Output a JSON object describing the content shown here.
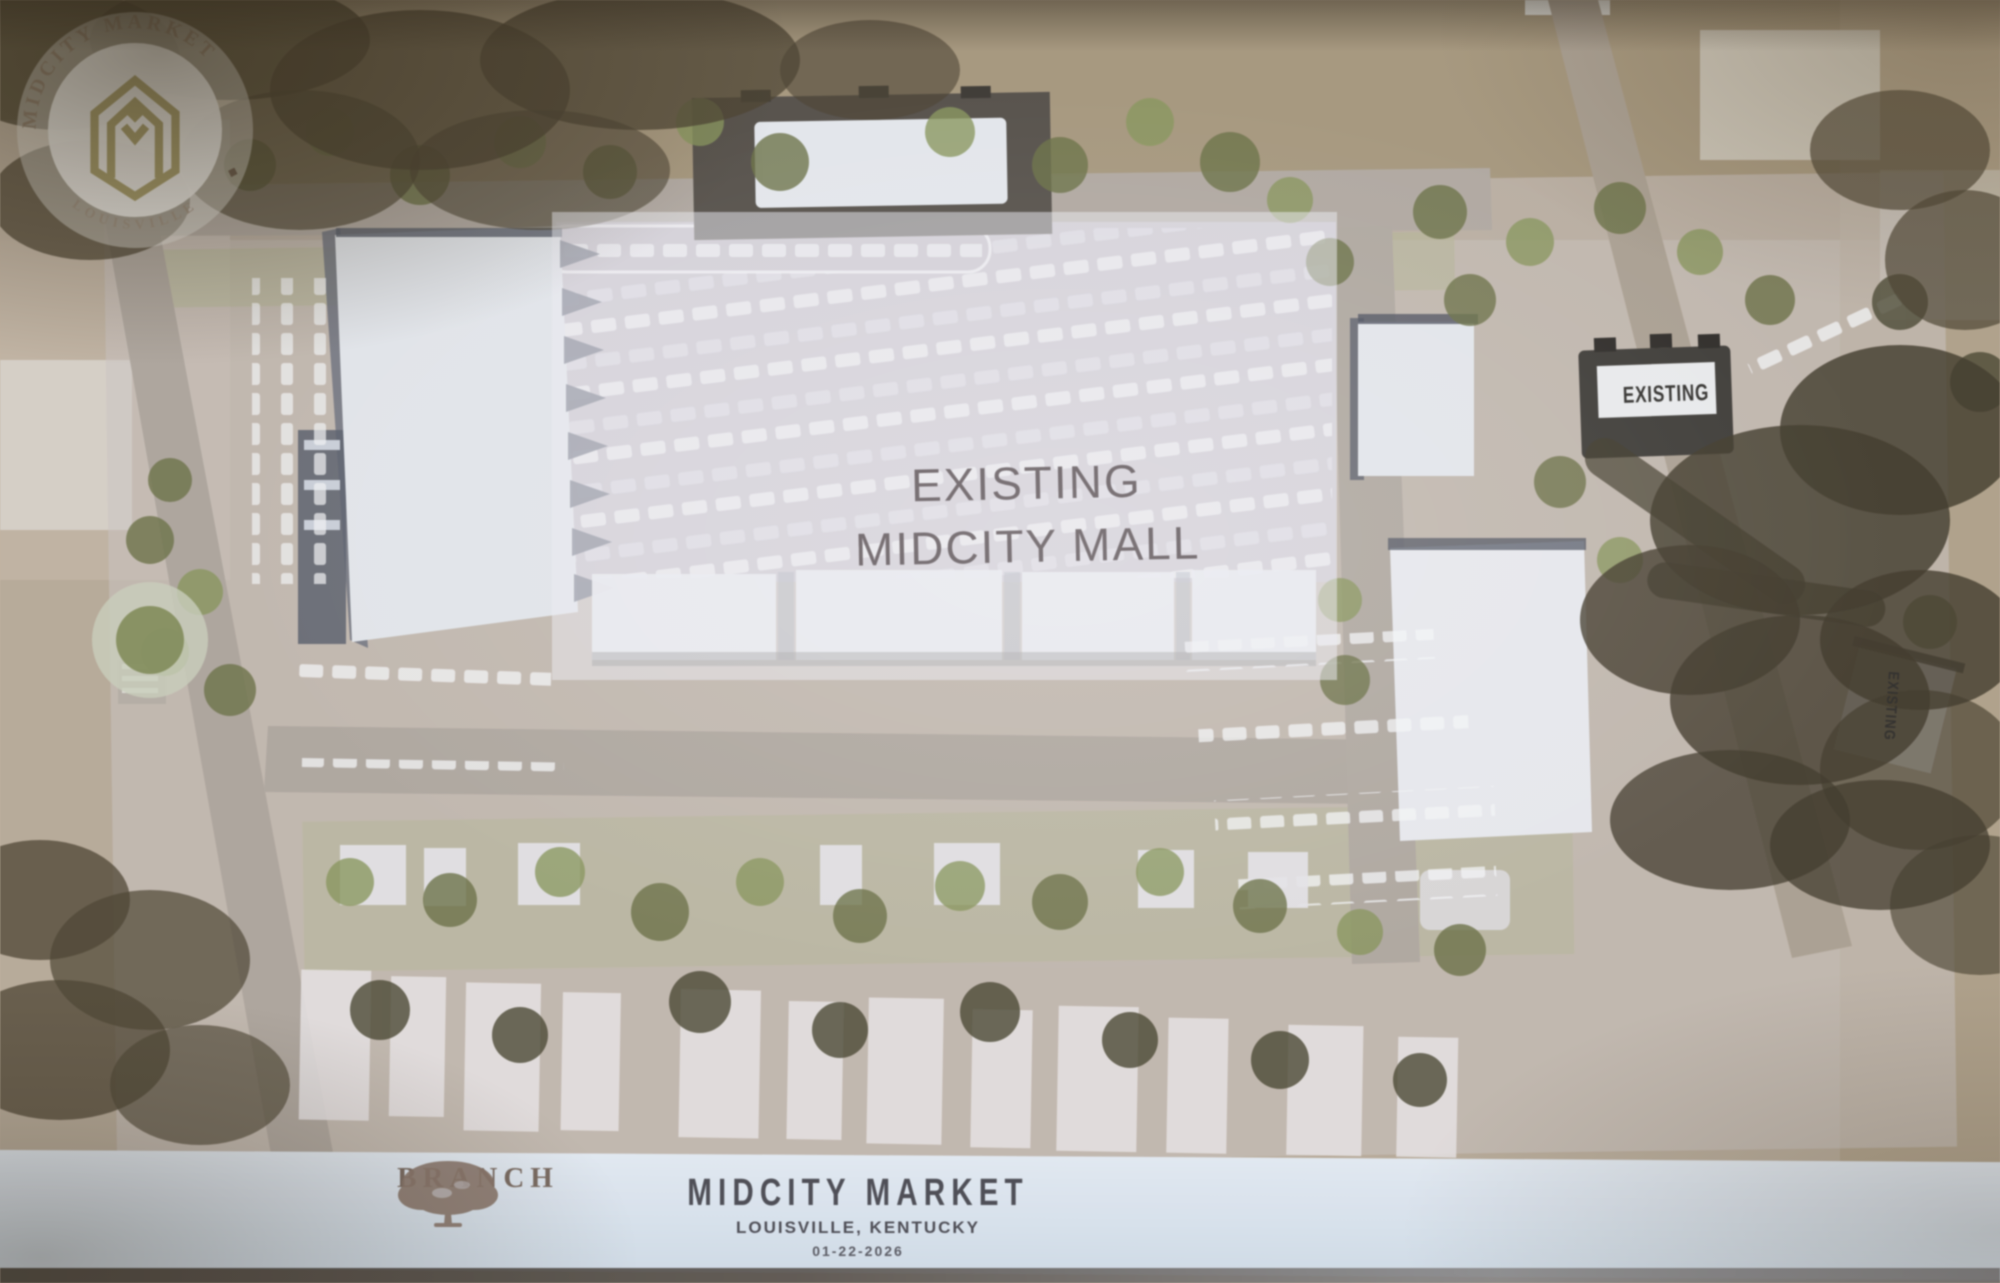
{
  "site_plan": {
    "mall_overlay_label": {
      "line1": "EXISTING",
      "line2": "MIDCITY MALL"
    },
    "building_labels": [
      {
        "id": "northeast-existing-building",
        "text": "EXISTING"
      },
      {
        "id": "east-existing-building",
        "text": "EXISTING"
      }
    ]
  },
  "footer": {
    "badge": {
      "arc_top": "MIDCITY MARKET",
      "separator": "◆",
      "arc_bottom": "LOUISVILLE"
    },
    "branch_logo_text": "BRANCH",
    "project_title": "MIDCITY MARKET",
    "project_location": "LOUISVILLE, KENTUCKY",
    "project_date": "01-22-2026"
  },
  "colors": {
    "badge_gold": "#A59754",
    "footer_band": "#DEE9F4",
    "title_text": "#4C4C56",
    "mall_label_text": "#5E5257",
    "branch_text": "#7B695E"
  }
}
